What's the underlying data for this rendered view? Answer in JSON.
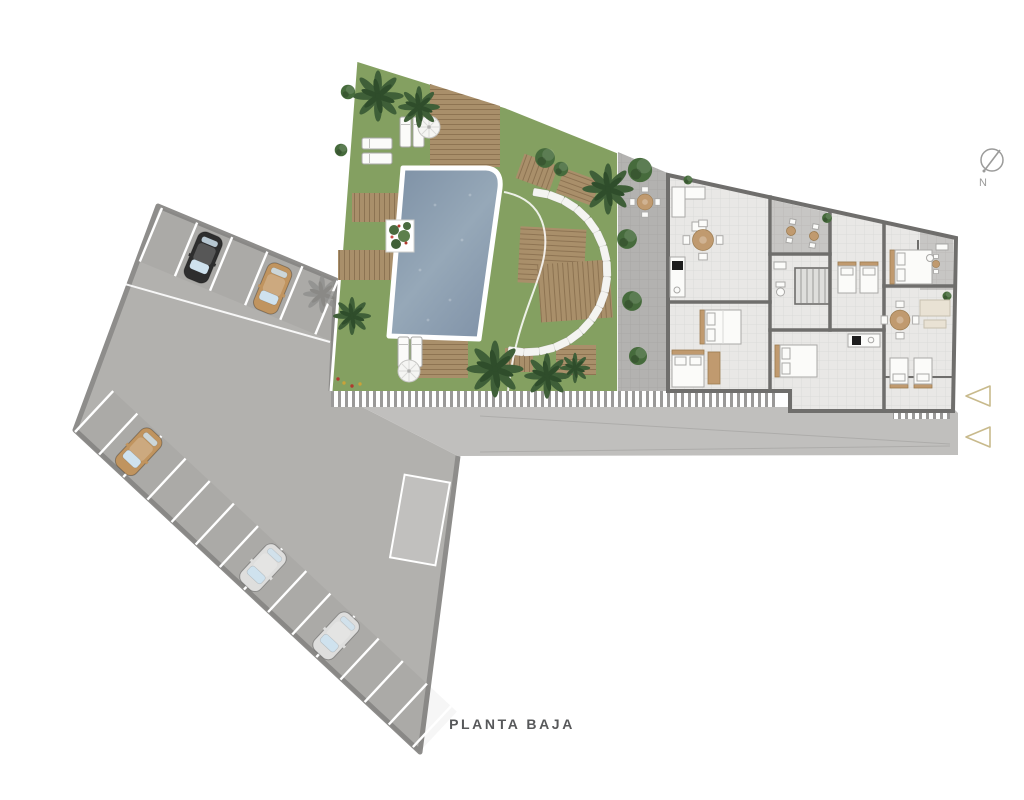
{
  "meta": {
    "title": "PLANTA BAJA"
  },
  "compass": {
    "label": "N"
  },
  "entrance_arrows": {
    "count": 2,
    "direction": "left"
  },
  "parking": {
    "top_row_stalls": 6,
    "side_row_stalls": 14,
    "cars": [
      {
        "row": "top",
        "color_name": "black"
      },
      {
        "row": "top",
        "color_name": "tan"
      },
      {
        "row": "side",
        "color_name": "tan"
      },
      {
        "row": "side",
        "color_name": "silver"
      },
      {
        "row": "side",
        "color_name": "silver"
      }
    ]
  },
  "garden": {
    "stepping_stones": 17,
    "palm_trees": 7,
    "umbrellas": 2,
    "sun_loungers": 6,
    "pool": true,
    "wood_decks": 8
  },
  "building": {
    "terraces": 2,
    "stairwell": true
  },
  "palette": {
    "background": "#ffffff",
    "grass": "#84a061",
    "pool_deep": "#7d90a5",
    "pool_light": "#98aaba",
    "pool_border": "#ffffff",
    "deck_wood": "#a98f6a",
    "paving": "#b3b2b0",
    "building_floor": "#e9e8e6",
    "terrace_floor": "#c7c6c4",
    "wall": "#6f6e6c",
    "parking_surface": "#b2b1ae",
    "parking_border": "#8e8d8b",
    "road": "#c0bfbd",
    "stall_line": "#ffffff",
    "hatch_gray": "#9a9998",
    "palm_green": "#3f5f38",
    "palm_dark": "#2f4d2b",
    "bush_green": "#466b3c",
    "stone_white": "#f4f4f1",
    "furniture_white": "#fbfbf9",
    "furniture_wood": "#c09a6f",
    "car_black": "#2e2e2e",
    "car_tan": "#c0945f",
    "car_silver": "#dededd",
    "arrow_tan": "#c8ba8c",
    "text_gray": "#57585a",
    "compass_gray": "#9b9b9a"
  }
}
